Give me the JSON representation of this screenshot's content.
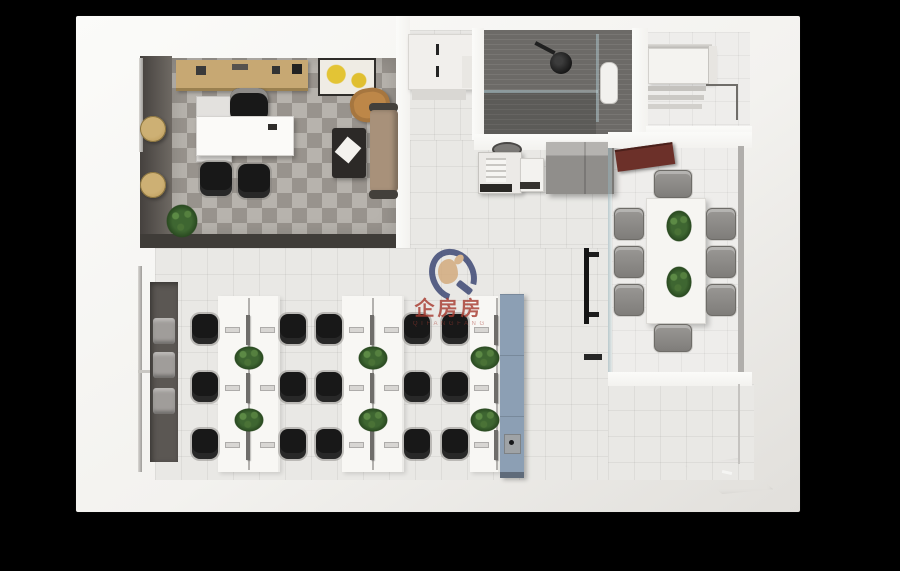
{
  "meta": {
    "scene_type": "3d-rendered office floor plan, top-down axonometric view",
    "background_color": "#000000"
  },
  "watermark": {
    "title": "企房房",
    "subtitle": "Q I F A N G F A N G",
    "logo": "qifangfang-q-logo"
  },
  "colors": {
    "bg": "#000000",
    "shell": "#f3f2ef",
    "shell-hi": "#fbfbf9",
    "shell-sh": "#e1dfdb",
    "wall-dark": "#55514d",
    "band-dark": "#3f3c38",
    "niche": "#5b5753",
    "carpet": "#a9a49d",
    "floor": "#e9e8e5",
    "meet-floor": "#eeedeb",
    "bath": "#6c6a67",
    "bench": "#f8f7f4",
    "chair-black": "#181818",
    "chair-gray": "#8f8d8a",
    "plant": "#3e6631",
    "plant-dark": "#2a4a21",
    "blue": "#8c9fb4",
    "mat": "#8b7352",
    "panel-red": "#6c3029",
    "wood": "#c7a873",
    "sofa": "#a8917a",
    "lounge": "#bd8748",
    "pouf": "#c2a263",
    "ctable": "#2c2927",
    "monitor": "#6f6d6a",
    "tv": "#151515",
    "wm-red": "#a83c31",
    "wm-navy": "#333f6e",
    "wm-tan": "#d2a878"
  },
  "scene": {
    "rooms": [
      {
        "name": "executive-office",
        "floor": "gray carpet tiles",
        "furniture": [
          "wood-credenza",
          "yellow-artwork",
          "side-cabinet",
          "executive-desk",
          "executive-chair",
          "guest-chair",
          "guest-chair",
          "lounge-chair",
          "coffee-table",
          "sofa",
          "plant",
          "pouf",
          "pouf",
          "glass-door"
        ]
      },
      {
        "name": "storage-closet",
        "furniture": [
          "white-cabinet-two-handles",
          "shelf"
        ]
      },
      {
        "name": "bathroom",
        "floor": "dark gray tile",
        "furniture": [
          "ceiling-shower-fixture",
          "glass-partition",
          "glass-partition",
          "toilet"
        ]
      },
      {
        "name": "storage-room",
        "furniture": [
          "white-cabinet",
          "shelf-stack",
          "counter-edge"
        ]
      },
      {
        "name": "kitchenette",
        "furniture": [
          "waste-bin",
          "copier",
          "water-dispenser",
          "gray-cabinet"
        ]
      },
      {
        "name": "meeting-room",
        "floor": "white tile",
        "furniture": [
          "red-ceiling-panel",
          "conference-table",
          "plant",
          "plant",
          "tv-on-glass-wall"
        ],
        "chairs": 8
      },
      {
        "name": "open-office",
        "floor": "light tile",
        "workstation_benches": 3,
        "seats_per_bench": [
          6,
          6,
          3
        ],
        "plants_per_bench": 2,
        "furniture": [
          "entry-glass-door",
          "wall-niche-with-cushions",
          "blue-side-cabinet",
          "small-device"
        ]
      },
      {
        "name": "entrance",
        "furniture": [
          "brown-doormat"
        ]
      }
    ]
  }
}
